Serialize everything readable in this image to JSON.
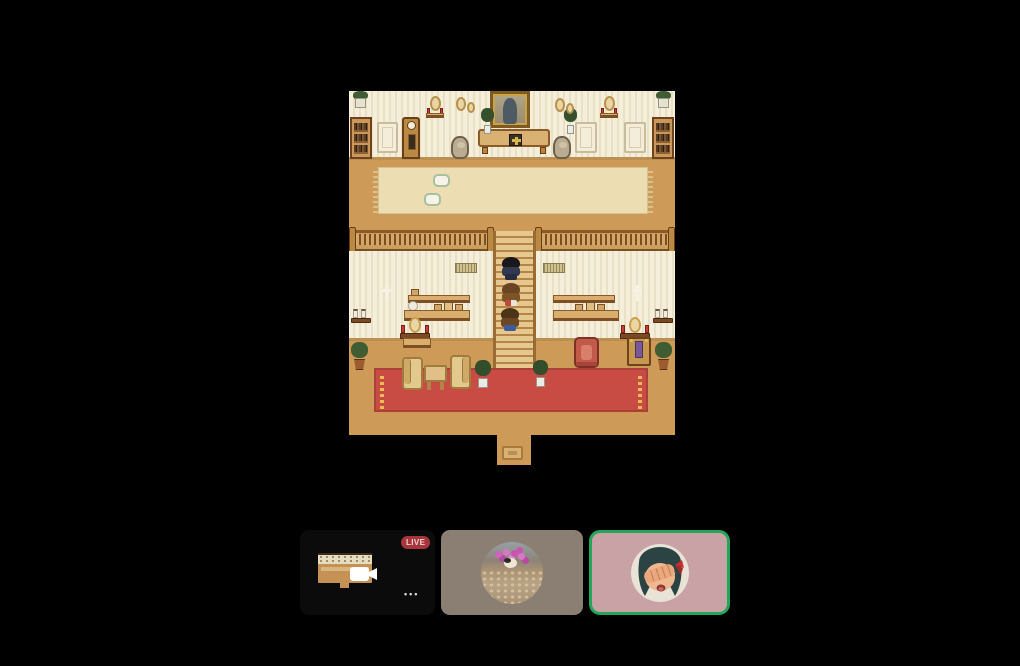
{
  "page": {
    "background": "#000000"
  },
  "game": {
    "description": "top-down pixel-art mansion hall with central staircase",
    "palette": {
      "floor": "#cd9a58",
      "wallpaper": "#f4eeda",
      "wood_light": "#d9ae6e",
      "wood_dark": "#8a5a28",
      "area_rug": "#ecddb2",
      "red_carpet": "#c84c44",
      "carpet_fringe": "#e9bd55",
      "stairs": "#e6c78e"
    },
    "characters": [
      {
        "name": "kid-black-hair"
      },
      {
        "name": "kid-brown-jacket"
      },
      {
        "name": "kid-blue-pants"
      }
    ]
  },
  "strip": {
    "stream_tile": {
      "live_label": "LIVE",
      "live_badge_color": "#a8353c",
      "more_label": "•••",
      "icons": [
        "video-camera-icon",
        "more-options-icon"
      ]
    },
    "participants": [
      {
        "name": "flower-pond-avatar",
        "tile_color": "#8b7f73",
        "speaking": false
      },
      {
        "name": "anime-girl-avatar",
        "tile_color": "#c8a2a5",
        "speaking": true,
        "speaking_ring_color": "#23a55a"
      }
    ]
  }
}
